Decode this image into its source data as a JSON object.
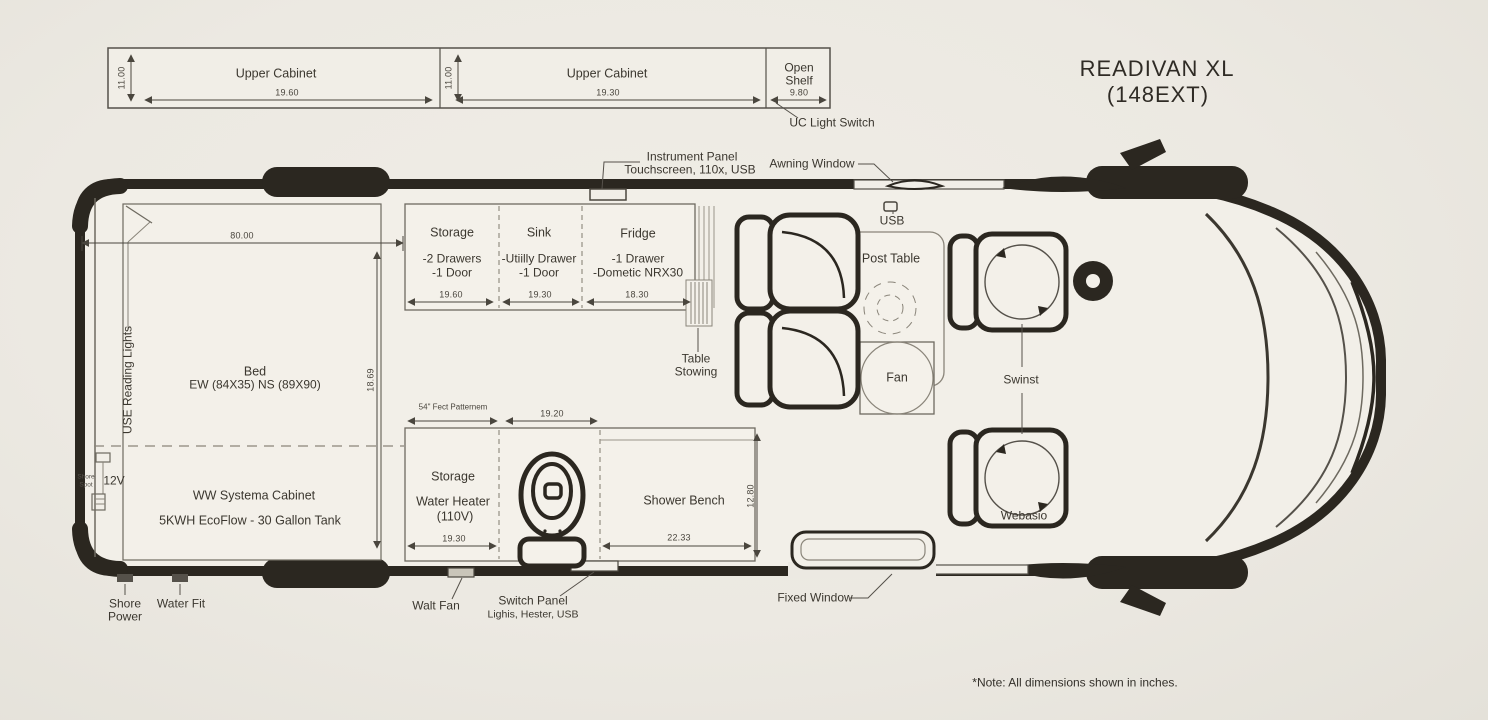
{
  "title": {
    "line1": "READIVAN XL",
    "line2": "(148EXT)"
  },
  "note": "*Note: All dimensions shown in inches.",
  "upper_cabinets": {
    "cabinet1": {
      "label": "Upper Cabinet",
      "width": "19.60",
      "height": "11.00"
    },
    "cabinet2": {
      "label": "Upper Cabinet",
      "width": "19.30",
      "height": "11.00"
    },
    "open_shelf": {
      "line1": "Open",
      "line2": "Shelf",
      "width": "9.80"
    },
    "uc_light_switch": "UC Light Switch"
  },
  "top_callouts": {
    "instrument_panel_line1": "Instrument Panel",
    "instrument_panel_line2": "Touchscreen, 110x, USB",
    "awning_window": "Awning Window",
    "usb": "USB"
  },
  "kitchen": {
    "storage": {
      "title": "Storage",
      "detail1": "-2 Drawers",
      "detail2": "-1 Door",
      "width": "19.60"
    },
    "sink": {
      "title": "Sink",
      "detail1": "-Utiilly Drawer",
      "detail2": "-1 Door",
      "width": "19.30"
    },
    "fridge": {
      "title": "Fridge",
      "detail1": "-1 Drawer",
      "detail2": "-Dometic NRX30",
      "width": "18.30"
    }
  },
  "bed_area": {
    "label": "Bed",
    "size": "EW (84X35) NS (89X90)",
    "length": "80.00",
    "depth": "18.69",
    "reading_lights": "USE Reading Lights",
    "cabinet": "WW Systema Cabinet",
    "systems": "5KWH EcoFlow - 30 Gallon Tank",
    "outlet": "12V",
    "wall_label_line1": "Shore",
    "wall_label_line2": "Spot"
  },
  "bath": {
    "storage_title": "Storage",
    "water_heater": "Water Heater",
    "voltage": "(110V)",
    "storage_width": "19.30",
    "toilet_width": "19.20",
    "foot_pattern": "54\" Fect Patternem",
    "shower_bench": "Shower Bench",
    "bench_width": "22.33",
    "bench_depth": "12.80"
  },
  "lounge": {
    "post_table": "Post Table",
    "fan": "Fan",
    "table_stowing_line1": "Table",
    "table_stowing_line2": "Stowing",
    "swivel": "Swinst",
    "webasto": "Webasio"
  },
  "bottom_callouts": {
    "shore_power_line1": "Shore",
    "shore_power_line2": "Power",
    "water_fit": "Water Fit",
    "walt_fan": "Walt Fan",
    "switch_panel": "Switch Panel",
    "switch_panel_detail": "Lighis, Hester, USB",
    "fixed_window": "Fixed Window"
  }
}
